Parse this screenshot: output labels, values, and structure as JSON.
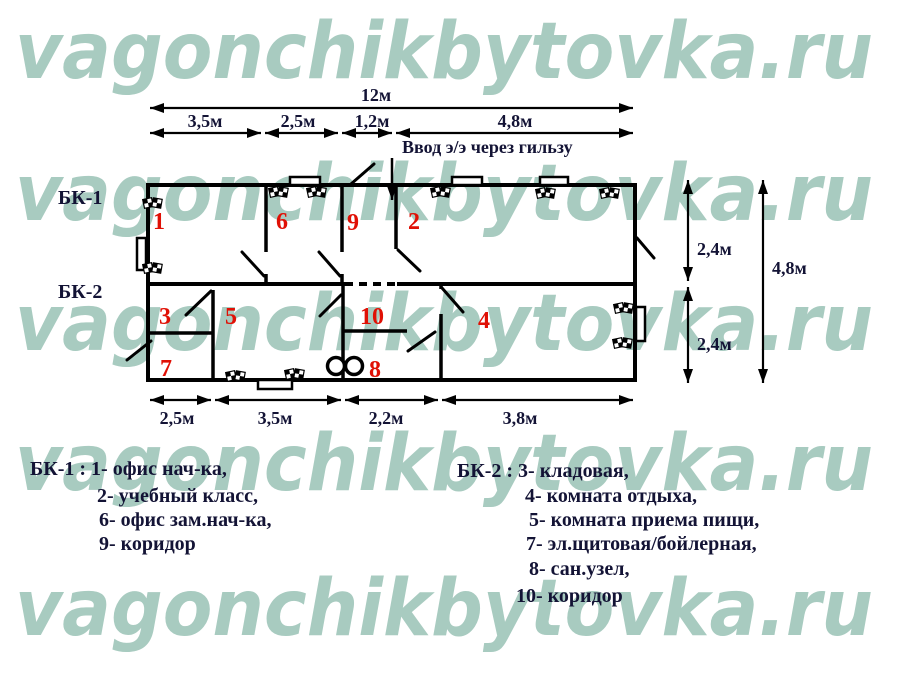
{
  "watermark": {
    "text": "vagonchikbytovka.ru",
    "color": "#a8cbc0"
  },
  "entry_note": "Ввод э/э через гильзу",
  "blocks": {
    "bk1": "БК-1",
    "bk2": "БК-2"
  },
  "rooms": [
    "1",
    "6",
    "9",
    "2",
    "3",
    "5",
    "10",
    "4",
    "7",
    "8"
  ],
  "dimensions": {
    "total_width": "12м",
    "top": [
      "3,5м",
      "2,5м",
      "1,2м",
      "4,8м"
    ],
    "bottom": [
      "2,5м",
      "3,5м",
      "2,2м",
      "3,8м"
    ],
    "right_upper": "2,4м",
    "right_lower": "2,4м",
    "total_height": "4,8м"
  },
  "legend": {
    "bk1_lines": [
      "БК-1 : 1- офис нач-ка,",
      "2- учебный класс,",
      "6- офис зам.нач-ка,",
      "9- коридор"
    ],
    "bk2_lines": [
      "БК-2 : 3- кладовая,",
      "4- комната отдыха,",
      "5- комната приема пищи,",
      "7- эл.щитовая/бойлерная,",
      "8- сан.узел,",
      "10- коридор"
    ]
  },
  "colors": {
    "watermark": "#a8cbc0",
    "ink": "#131335",
    "room_number": "#e01005",
    "wall": "#000000"
  }
}
